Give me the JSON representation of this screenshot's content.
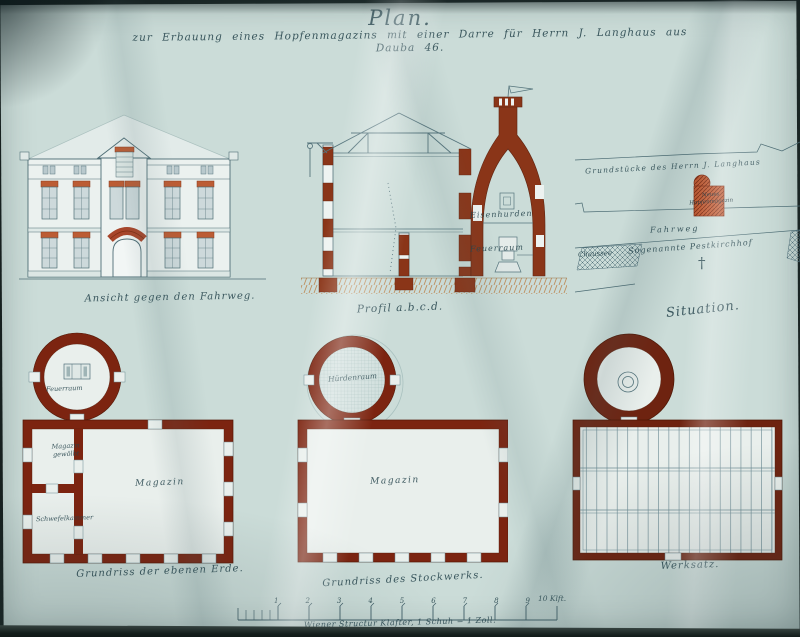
{
  "header": {
    "title": "Plan.",
    "subtitle": "zur Erbauung eines Hopfenmagazins mit einer Darre für Herrn J. Langhaus aus Dauba 46."
  },
  "drawings": {
    "elevation": {
      "caption": "Ansicht gegen den Fahrweg."
    },
    "profile": {
      "caption": "Profil a.b.c.d.",
      "hurdle_label": "Eisenhurden",
      "fire_label": "Feuerraum"
    },
    "situation": {
      "caption": "Situation.",
      "property_label": "Grundstücke des Herrn J. Langhaus",
      "building_label": "Neues Hopfenmagazin",
      "road_label": "Fahrweg",
      "chaussee_label": "Chaussee",
      "churchyard_label": "Sogenannte Pestkirchhof",
      "cross_symbol": "†"
    },
    "ground_floor": {
      "caption": "Grundriss der ebenen Erde.",
      "kiln_label": "Feuerraum",
      "vaulted_label": "Magazin gewölbt",
      "sulfur_label": "Schwefelkammer",
      "magazine_label": "Magazin"
    },
    "upper_floor": {
      "caption": "Grundriss des Stockwerks.",
      "hurdle_room_label": "Hürdenraum",
      "magazine_label": "Magazin"
    },
    "roof": {
      "caption": "Werksatz."
    }
  },
  "scale_bar": {
    "tick_labels": [
      "1",
      "2",
      "3",
      "4",
      "5",
      "6",
      "7",
      "8",
      "9"
    ],
    "end_label": "10 Klft.",
    "caption": "Wiener Structur Klafter, 1 Schuh = 1 Zoll."
  },
  "colors": {
    "masonry_dark": "#7c2410",
    "masonry_roofplan": "#6e2310",
    "brick_lintel": "#bc5c34",
    "site_building": "#c05a32",
    "ink": "#3c5a63",
    "ground_hatch": "#bd8a56",
    "paper": "#cfdfdb"
  }
}
